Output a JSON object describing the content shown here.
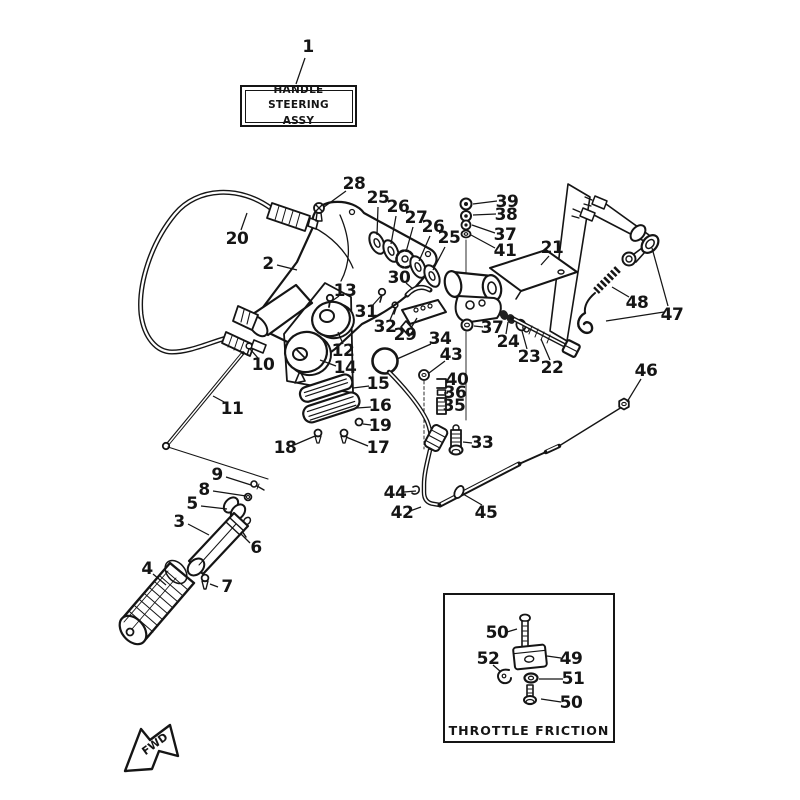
{
  "diagram": {
    "title_box": {
      "line1": "HANDLE STEERING",
      "line2": "ASSY"
    },
    "inset_box": {
      "title": "THROTTLE FRICTION"
    },
    "fwd_label": "FWD",
    "colors": {
      "line": "#151515",
      "background": "#ffffff"
    },
    "callouts": [
      {
        "label": "1",
        "x": 308,
        "y": 47,
        "leaders": [
          [
            [
              305,
              58
            ],
            [
              296,
              84
            ]
          ]
        ]
      },
      {
        "label": "20",
        "x": 237,
        "y": 239,
        "leaders": [
          [
            [
              241,
              230
            ],
            [
              247,
              213
            ]
          ]
        ]
      },
      {
        "label": "28",
        "x": 354,
        "y": 184,
        "leaders": [
          [
            [
              346,
              191
            ],
            [
              324,
              207
            ]
          ]
        ]
      },
      {
        "label": "2",
        "x": 268,
        "y": 264,
        "leaders": [
          [
            [
              277,
              265
            ],
            [
              297,
              270
            ]
          ]
        ]
      },
      {
        "label": "25",
        "x": 378,
        "y": 198,
        "leaders": [
          [
            [
              378,
              207
            ],
            [
              377,
              235
            ]
          ]
        ]
      },
      {
        "label": "26",
        "x": 398,
        "y": 207,
        "leaders": [
          [
            [
              396,
              216
            ],
            [
              391,
              244
            ]
          ]
        ]
      },
      {
        "label": "27",
        "x": 416,
        "y": 218,
        "leaders": [
          [
            [
              413,
              227
            ],
            [
              406,
              252
            ]
          ]
        ]
      },
      {
        "label": "26",
        "x": 433,
        "y": 227,
        "leaders": [
          [
            [
              430,
              236
            ],
            [
              419,
              261
            ]
          ]
        ]
      },
      {
        "label": "25",
        "x": 449,
        "y": 238,
        "leaders": [
          [
            [
              445,
              247
            ],
            [
              433,
              270
            ]
          ]
        ]
      },
      {
        "label": "39",
        "x": 507,
        "y": 202,
        "leaders": [
          [
            [
              497,
              201
            ],
            [
              473,
              204
            ]
          ]
        ]
      },
      {
        "label": "38",
        "x": 506,
        "y": 215,
        "leaders": [
          [
            [
              496,
              214
            ],
            [
              473,
              215
            ]
          ]
        ]
      },
      {
        "label": "37",
        "x": 505,
        "y": 235,
        "leaders": [
          [
            [
              495,
              233
            ],
            [
              472,
              225
            ]
          ]
        ]
      },
      {
        "label": "41",
        "x": 505,
        "y": 251,
        "leaders": [
          [
            [
              495,
              248
            ],
            [
              471,
              235
            ]
          ]
        ]
      },
      {
        "label": "21",
        "x": 552,
        "y": 248,
        "leaders": [
          [
            [
              549,
              256
            ],
            [
              541,
              265
            ]
          ]
        ]
      },
      {
        "label": "13",
        "x": 345,
        "y": 291,
        "leaders": [
          [
            [
              339,
              296
            ],
            [
              332,
              301
            ]
          ]
        ]
      },
      {
        "label": "31",
        "x": 366,
        "y": 312,
        "leaders": [
          [
            [
              372,
              306
            ],
            [
              381,
              296
            ]
          ]
        ]
      },
      {
        "label": "30",
        "x": 399,
        "y": 278,
        "leaders": [
          [
            [
              406,
              283
            ],
            [
              413,
              289
            ]
          ]
        ]
      },
      {
        "label": "32",
        "x": 385,
        "y": 327,
        "leaders": [
          [
            [
              390,
              320
            ],
            [
              395,
              308
            ]
          ]
        ]
      },
      {
        "label": "29",
        "x": 405,
        "y": 335,
        "leaders": [
          [
            [
              411,
              328
            ],
            [
              417,
              318
            ]
          ]
        ]
      },
      {
        "label": "12",
        "x": 343,
        "y": 351,
        "leaders": [
          [
            [
              343,
              344
            ],
            [
              338,
              332
            ]
          ]
        ]
      },
      {
        "label": "14",
        "x": 345,
        "y": 368,
        "leaders": [
          [
            [
              336,
              366
            ],
            [
              320,
              360
            ]
          ]
        ]
      },
      {
        "label": "34",
        "x": 440,
        "y": 339,
        "leaders": [
          [
            [
              431,
              344
            ],
            [
              397,
              359
            ]
          ]
        ]
      },
      {
        "label": "43",
        "x": 451,
        "y": 355,
        "leaders": [
          [
            [
              445,
              361
            ],
            [
              429,
              373
            ]
          ]
        ]
      },
      {
        "label": "37",
        "x": 492,
        "y": 328,
        "leaders": [
          [
            [
              483,
              327
            ],
            [
              474,
              326
            ]
          ]
        ]
      },
      {
        "label": "24",
        "x": 508,
        "y": 342,
        "leaders": [
          [
            [
              506,
              334
            ],
            [
              508,
              322
            ]
          ]
        ]
      },
      {
        "label": "23",
        "x": 529,
        "y": 357,
        "leaders": [
          [
            [
              527,
              349
            ],
            [
              522,
              331
            ]
          ]
        ]
      },
      {
        "label": "22",
        "x": 552,
        "y": 368,
        "leaders": [
          [
            [
              550,
              360
            ],
            [
              541,
              339
            ]
          ]
        ]
      },
      {
        "label": "48",
        "x": 637,
        "y": 303,
        "leaders": [
          [
            [
              629,
              297
            ],
            [
              612,
              287
            ]
          ]
        ]
      },
      {
        "label": "47",
        "x": 672,
        "y": 315,
        "leaders": [
          [
            [
              668,
              306
            ],
            [
              652,
              248
            ]
          ],
          [
            [
              664,
              312
            ],
            [
              606,
              321
            ]
          ]
        ]
      },
      {
        "label": "46",
        "x": 646,
        "y": 371,
        "leaders": [
          [
            [
              641,
              379
            ],
            [
              627,
              402
            ]
          ]
        ]
      },
      {
        "label": "15",
        "x": 378,
        "y": 384,
        "leaders": [
          [
            [
              369,
              386
            ],
            [
              353,
              388
            ]
          ]
        ]
      },
      {
        "label": "16",
        "x": 380,
        "y": 406,
        "leaders": [
          [
            [
              371,
              407
            ],
            [
              357,
              408
            ]
          ]
        ]
      },
      {
        "label": "19",
        "x": 380,
        "y": 426,
        "leaders": [
          [
            [
              371,
              425
            ],
            [
              363,
              424
            ]
          ]
        ]
      },
      {
        "label": "17",
        "x": 378,
        "y": 448,
        "leaders": [
          [
            [
              368,
              446
            ],
            [
              346,
              437
            ]
          ]
        ]
      },
      {
        "label": "18",
        "x": 285,
        "y": 448,
        "leaders": [
          [
            [
              294,
              445
            ],
            [
              315,
              436
            ]
          ]
        ]
      },
      {
        "label": "40",
        "x": 457,
        "y": 380,
        "leaders": [
          [
            [
              449,
              381
            ],
            [
              447,
              383
            ]
          ]
        ]
      },
      {
        "label": "36",
        "x": 455,
        "y": 393,
        "leaders": [
          [
            [
              448,
              393
            ],
            [
              444,
              393
            ]
          ]
        ]
      },
      {
        "label": "35",
        "x": 454,
        "y": 406,
        "leaders": [
          [
            [
              447,
              405
            ],
            [
              445,
              404
            ]
          ]
        ]
      },
      {
        "label": "33",
        "x": 482,
        "y": 443,
        "leaders": [
          [
            [
              472,
              443
            ],
            [
              463,
              442
            ]
          ]
        ]
      },
      {
        "label": "10",
        "x": 263,
        "y": 365,
        "leaders": [
          [
            [
              258,
              358
            ],
            [
              250,
              349
            ]
          ]
        ]
      },
      {
        "label": "11",
        "x": 232,
        "y": 409,
        "leaders": [
          [
            [
              226,
              403
            ],
            [
              213,
              396
            ]
          ]
        ]
      },
      {
        "label": "9",
        "x": 217,
        "y": 475,
        "leaders": [
          [
            [
              226,
              477
            ],
            [
              251,
              485
            ]
          ]
        ]
      },
      {
        "label": "8",
        "x": 204,
        "y": 490,
        "leaders": [
          [
            [
              213,
              491
            ],
            [
              246,
              496
            ]
          ]
        ]
      },
      {
        "label": "5",
        "x": 192,
        "y": 504,
        "leaders": [
          [
            [
              201,
              506
            ],
            [
              227,
              509
            ]
          ]
        ]
      },
      {
        "label": "3",
        "x": 179,
        "y": 522,
        "leaders": [
          [
            [
              188,
              524
            ],
            [
              209,
              535
            ]
          ]
        ]
      },
      {
        "label": "6",
        "x": 256,
        "y": 548,
        "leaders": [
          [
            [
              250,
              543
            ],
            [
              241,
              534
            ]
          ]
        ]
      },
      {
        "label": "4",
        "x": 147,
        "y": 569,
        "leaders": [
          [
            [
              153,
              574
            ],
            [
              166,
              585
            ]
          ]
        ]
      },
      {
        "label": "7",
        "x": 227,
        "y": 587,
        "leaders": [
          [
            [
              218,
              587
            ],
            [
              210,
              584
            ]
          ]
        ]
      },
      {
        "label": "44",
        "x": 395,
        "y": 493,
        "leaders": [
          [
            [
              404,
              492
            ],
            [
              416,
              491
            ]
          ]
        ]
      },
      {
        "label": "42",
        "x": 402,
        "y": 513,
        "leaders": [
          [
            [
              410,
              511
            ],
            [
              421,
              507
            ]
          ]
        ]
      },
      {
        "label": "45",
        "x": 486,
        "y": 513,
        "leaders": [
          [
            [
              482,
              505
            ],
            [
              463,
              494
            ]
          ]
        ]
      },
      {
        "label": "50",
        "x": 497,
        "y": 633,
        "leaders": [
          [
            [
              507,
              632
            ],
            [
              517,
              629
            ]
          ]
        ]
      },
      {
        "label": "52",
        "x": 488,
        "y": 659,
        "leaders": [
          [
            [
              493,
              665
            ],
            [
              501,
              672
            ]
          ]
        ]
      },
      {
        "label": "49",
        "x": 571,
        "y": 659,
        "leaders": [
          [
            [
              561,
              658
            ],
            [
              547,
              656
            ]
          ]
        ]
      },
      {
        "label": "51",
        "x": 573,
        "y": 679,
        "leaders": [
          [
            [
              563,
              679
            ],
            [
              539,
              679
            ]
          ]
        ]
      },
      {
        "label": "50",
        "x": 571,
        "y": 703,
        "leaders": [
          [
            [
              561,
              702
            ],
            [
              541,
              699
            ]
          ]
        ]
      }
    ]
  }
}
